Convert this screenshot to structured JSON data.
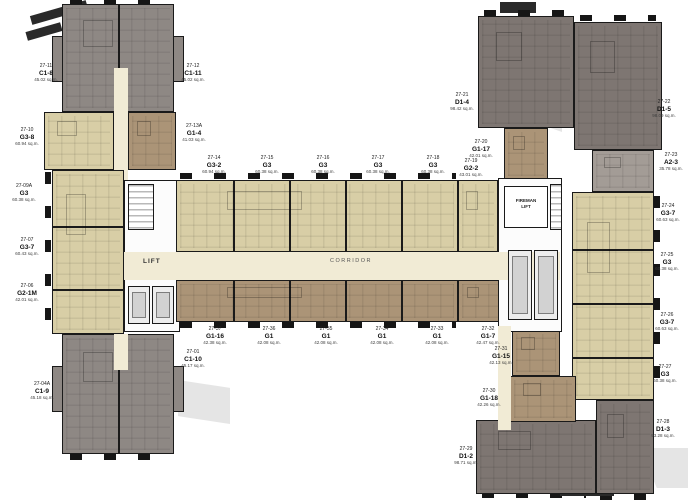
{
  "plan": {
    "corridor_label": "CORRIDOR",
    "lift_label": "LIFT",
    "fireman_lift_line1": "FIREMAN",
    "fireman_lift_line2": "LIFT",
    "units": [
      {
        "no": "27-11",
        "type": "C1-8",
        "area": "45.02 sq.m."
      },
      {
        "no": "27-12",
        "type": "C1-11",
        "area": "45.02 sq.m."
      },
      {
        "no": "27-10",
        "type": "G3-8",
        "area": "60.94 sq.m."
      },
      {
        "no": "27-13A",
        "type": "G1-4",
        "area": "41.03 sq.m."
      },
      {
        "no": "27-09A",
        "type": "G3",
        "area": "60.38 sq.m."
      },
      {
        "no": "27-07",
        "type": "G3-7",
        "area": "60.43 sq.m."
      },
      {
        "no": "27-06",
        "type": "G2-1M",
        "area": "42.01 sq.m."
      },
      {
        "no": "27-04A",
        "type": "C1-9",
        "area": "45.18 sq.m."
      },
      {
        "no": "27-01",
        "type": "C1-10",
        "area": "45.17 sq.m."
      },
      {
        "no": "27-14",
        "type": "G3-2",
        "area": "60.94 sq.m."
      },
      {
        "no": "27-15",
        "type": "G3",
        "area": "60.38 sq.m."
      },
      {
        "no": "27-16",
        "type": "G3",
        "area": "60.38 sq.m."
      },
      {
        "no": "27-17",
        "type": "G3",
        "area": "60.38 sq.m."
      },
      {
        "no": "27-18",
        "type": "G3",
        "area": "60.38 sq.m."
      },
      {
        "no": "27-19",
        "type": "G2-2",
        "area": "43.01 sq.m."
      },
      {
        "no": "27-20",
        "type": "G1-17",
        "area": "42.01 sq.m."
      },
      {
        "no": "27-21",
        "type": "D1-4",
        "area": "98.42 sq.m."
      },
      {
        "no": "27-22",
        "type": "D1-5",
        "area": "98.09 sq.m."
      },
      {
        "no": "27-23",
        "type": "A2-3",
        "area": "35.78 sq.m."
      },
      {
        "no": "27-24",
        "type": "G3-7",
        "area": "60.63 sq.m."
      },
      {
        "no": "27-25",
        "type": "G3",
        "area": "60.38 sq.m."
      },
      {
        "no": "27-26",
        "type": "G3-7",
        "area": "60.63 sq.m."
      },
      {
        "no": "27-27",
        "type": "G3",
        "area": "60.38 sq.m."
      },
      {
        "no": "27-28",
        "type": "D1-3",
        "area": "93.28 sq.m."
      },
      {
        "no": "27-29",
        "type": "D1-2",
        "area": "98.71 sq.m."
      },
      {
        "no": "27-30",
        "type": "G1-18",
        "area": "42.26 sq.m."
      },
      {
        "no": "27-31",
        "type": "G1-15",
        "area": "42.13 sq.m."
      },
      {
        "no": "27-32",
        "type": "G1-7",
        "area": "42.47 sq.m."
      },
      {
        "no": "27-33",
        "type": "G1",
        "area": "42.08 sq.m."
      },
      {
        "no": "27-34",
        "type": "G1",
        "area": "42.08 sq.m."
      },
      {
        "no": "27-35",
        "type": "G1",
        "area": "42.08 sq.m."
      },
      {
        "no": "27-36",
        "type": "G1",
        "area": "42.08 sq.m."
      },
      {
        "no": "27-37",
        "type": "G1-16",
        "area": "42.38 sq.m."
      }
    ],
    "colors": {
      "unit_beige": "#d8cea6",
      "unit_brown": "#ab9477",
      "unit_gray": "#8e8884",
      "unit_dark_gray": "#7e7672",
      "unit_medium_gray": "#a39c96",
      "corridor_cream": "#f1ebd5",
      "wall": "#1a1a1a"
    }
  }
}
